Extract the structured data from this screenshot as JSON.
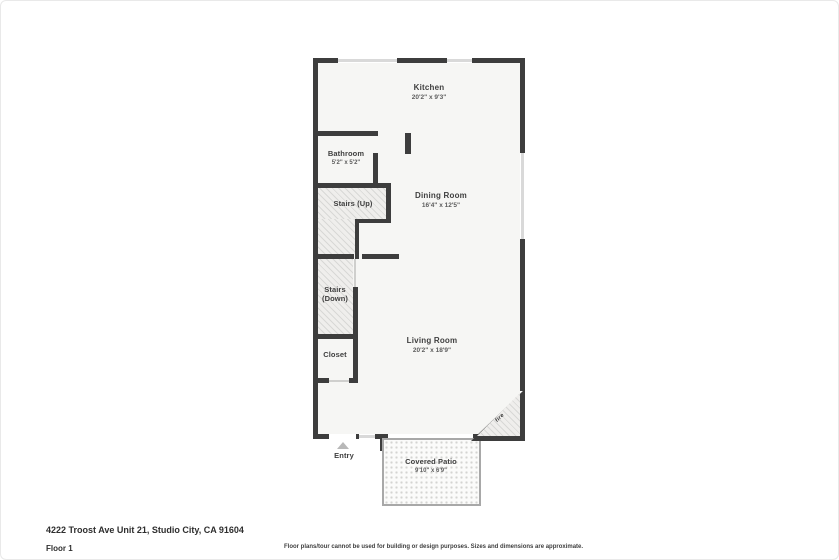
{
  "page": {
    "address": "4222 Troost Ave Unit 21, Studio City, CA 91604",
    "floor_label": "Floor 1",
    "disclaimer": "Floor plans/tour cannot be used for building or design purposes. Sizes and dimensions are approximate."
  },
  "floorplan": {
    "rooms": {
      "kitchen": {
        "name": "Kitchen",
        "dims": "20'2\" x 9'3\""
      },
      "bathroom": {
        "name": "Bathroom",
        "dims": "5'2\" x 5'2\""
      },
      "stairs_up": {
        "name": "Stairs (Up)"
      },
      "dining_room": {
        "name": "Dining Room",
        "dims": "16'4\" x 12'5\""
      },
      "stairs_down": {
        "line1": "Stairs",
        "line2": "(Down)"
      },
      "closet": {
        "name": "Closet"
      },
      "living_room": {
        "name": "Living Room",
        "dims": "20'2\" x 18'9\""
      },
      "entry": {
        "name": "Entry"
      },
      "covered_patio": {
        "name": "Covered Patio",
        "dims": "9'10\" x 6'9\""
      },
      "fireplace": {
        "name": "fire"
      }
    },
    "colors": {
      "wall": "#3d3d3d",
      "floor": "#f6f6f4",
      "window": "#d9d9d9",
      "patio_wall": "#a8a8a8",
      "hatch_line": "#d8d8d6"
    }
  }
}
